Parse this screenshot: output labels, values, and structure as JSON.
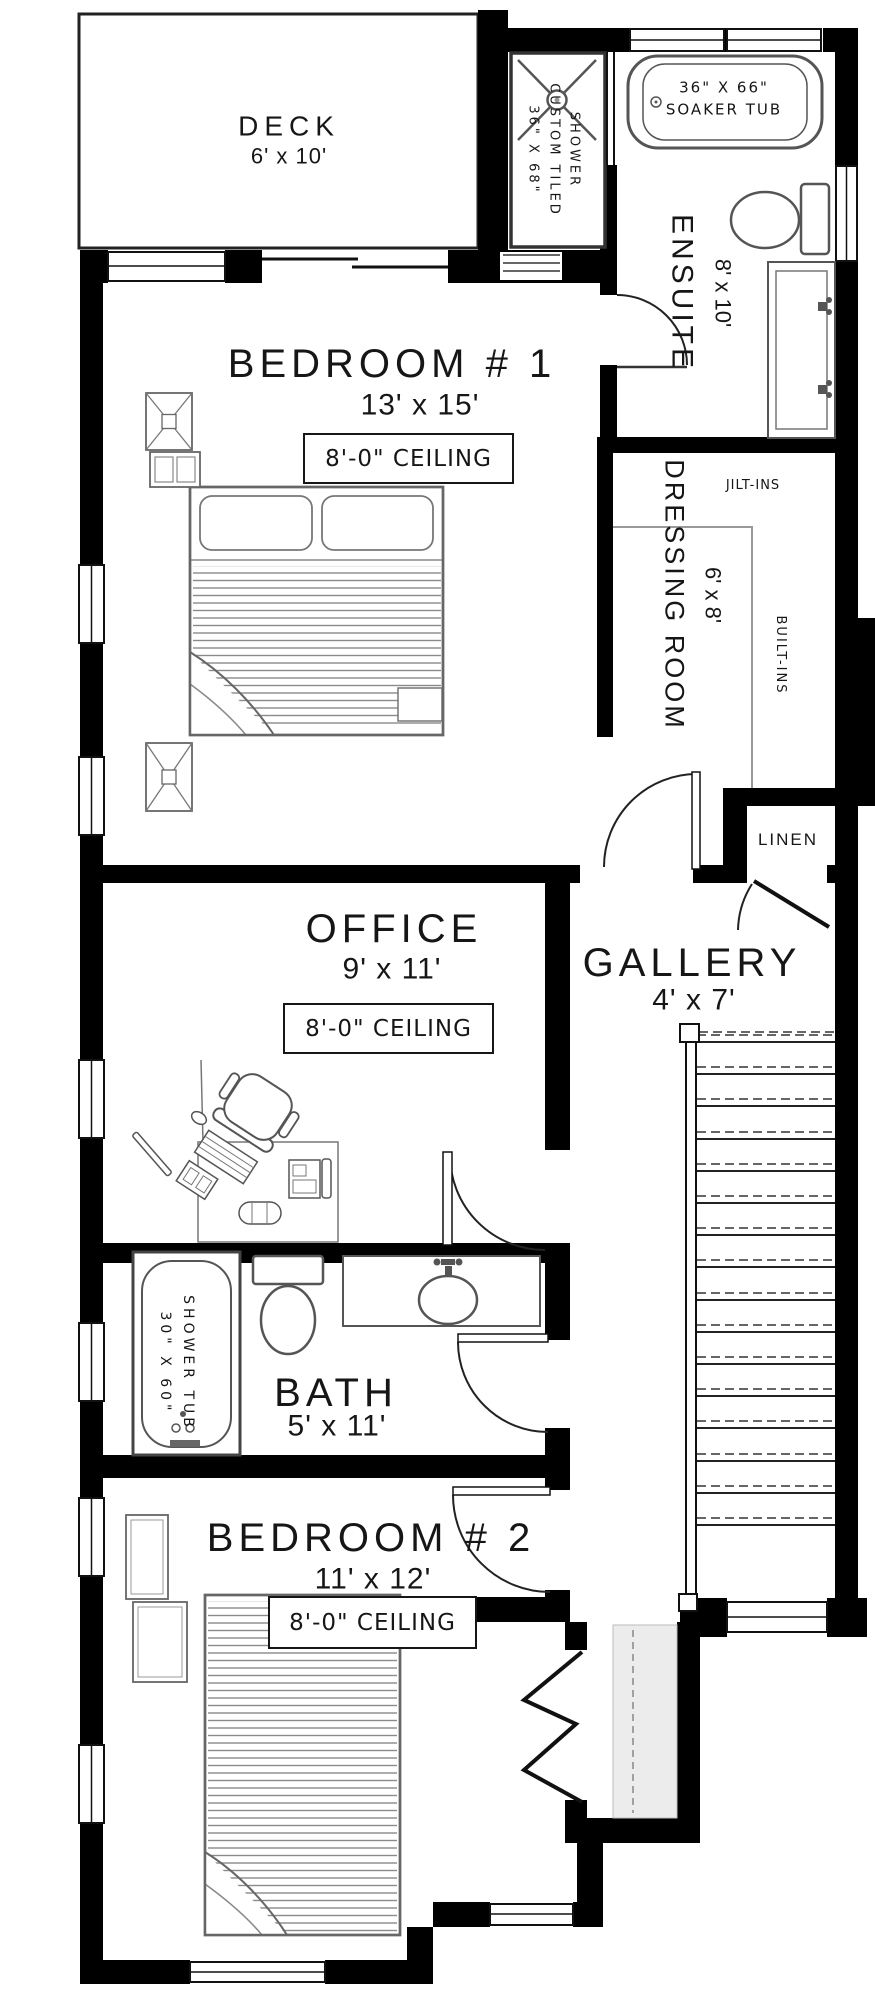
{
  "rooms": {
    "deck": {
      "name": "DECK",
      "size": "6' x 10'"
    },
    "bedroom1": {
      "name": "BEDROOM # 1",
      "size": "13' x 15'",
      "ceiling": "8'-0\" CEILING"
    },
    "ensuite": {
      "name": "ENSUITE",
      "size": "8' x 10'"
    },
    "dressing": {
      "name": "DRESSING ROOM",
      "size": "6' x 8'"
    },
    "gallery": {
      "name": "GALLERY",
      "size": "4' x 7'"
    },
    "office": {
      "name": "OFFICE",
      "size": "9' x 11'",
      "ceiling": "8'-0\" CEILING"
    },
    "bath": {
      "name": "BATH",
      "size": "5' x 11'"
    },
    "bedroom2": {
      "name": "BEDROOM # 2",
      "size": "11' x 12'",
      "ceiling": "8'-0\" CEILING"
    },
    "linen": {
      "name": "LINEN"
    }
  },
  "fixtures": {
    "custom_shower": {
      "line1": "36\" X 68\"",
      "line2": "CUSTOM TILED",
      "line3": "SHOWER"
    },
    "soaker_tub": {
      "line1": "36\" X 66\"",
      "line2": "SOAKER TUB"
    },
    "shower_tub": {
      "line1": "30\" X 60\"",
      "line2": "SHOWER TUB"
    },
    "builtins_top": "JILT-INS",
    "builtins_side": "BUILT-INS"
  },
  "colors": {
    "wall": "#000000",
    "furniture_line": "#555555",
    "text": "#161616",
    "background": "#ffffff"
  }
}
